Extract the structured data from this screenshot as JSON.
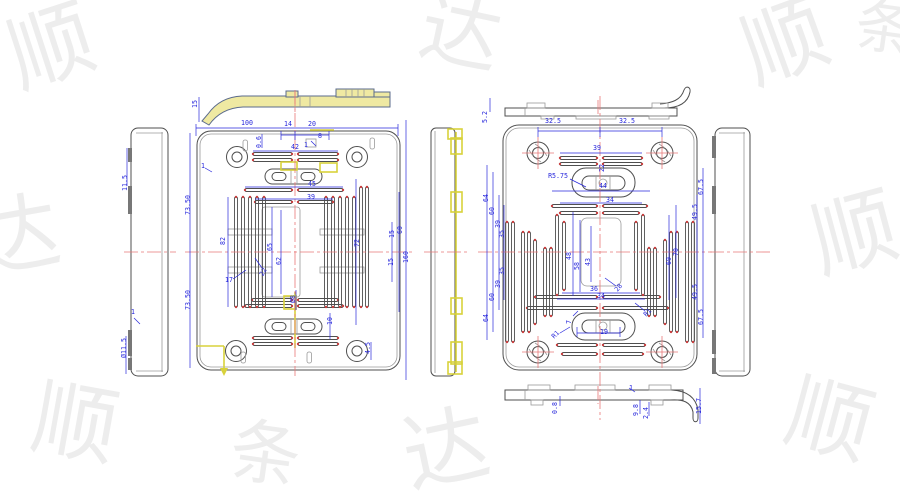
{
  "colors": {
    "background": "#FFFFFF",
    "dimension": "#2828DC",
    "geometry": "#4F4F4F",
    "highlight": "#D8D23B",
    "highlight_fill": "#EFE9A2",
    "centerline": "#E87878",
    "endpoint_marker": "#C84040",
    "watermark": "#EDEDED"
  },
  "dim_labels": [
    {
      "t": "15",
      "x": 197,
      "y": 104,
      "r": -90
    },
    {
      "t": "100",
      "x": 247,
      "y": 125,
      "r": 0
    },
    {
      "t": "14",
      "x": 288,
      "y": 126,
      "r": 0
    },
    {
      "t": "20",
      "x": 312,
      "y": 126,
      "r": 0
    },
    {
      "t": "0.6",
      "x": 261,
      "y": 142,
      "r": -90
    },
    {
      "t": "8",
      "x": 320,
      "y": 138,
      "r": 0
    },
    {
      "t": "1",
      "x": 306,
      "y": 147,
      "r": 0
    },
    {
      "t": "42",
      "x": 295,
      "y": 149,
      "r": 0
    },
    {
      "t": "1",
      "x": 203,
      "y": 168,
      "r": 0
    },
    {
      "t": "45",
      "x": 312,
      "y": 186,
      "r": 0
    },
    {
      "t": "39",
      "x": 311,
      "y": 199,
      "r": 0
    },
    {
      "t": "73.50",
      "x": 190,
      "y": 205,
      "r": -90
    },
    {
      "t": "73.50",
      "x": 190,
      "y": 300,
      "r": -90
    },
    {
      "t": "82",
      "x": 225,
      "y": 241,
      "r": -90
    },
    {
      "t": "17",
      "x": 229,
      "y": 282,
      "r": 0
    },
    {
      "t": "65",
      "x": 272,
      "y": 247,
      "r": -90
    },
    {
      "t": "62",
      "x": 281,
      "y": 261,
      "r": -90
    },
    {
      "t": "22",
      "x": 265,
      "y": 273,
      "r": -60
    },
    {
      "t": "72",
      "x": 359,
      "y": 243,
      "r": -90
    },
    {
      "t": "15",
      "x": 394,
      "y": 234,
      "r": -90
    },
    {
      "t": "60",
      "x": 402,
      "y": 230,
      "r": -90
    },
    {
      "t": "15",
      "x": 393,
      "y": 262,
      "r": -90
    },
    {
      "t": "160",
      "x": 408,
      "y": 257,
      "r": -90
    },
    {
      "t": "Ø8",
      "x": 295,
      "y": 299,
      "r": -90
    },
    {
      "t": "10",
      "x": 332,
      "y": 321,
      "r": -90
    },
    {
      "t": "4.5",
      "x": 370,
      "y": 348,
      "r": -90
    },
    {
      "t": "11.5",
      "x": 127,
      "y": 183,
      "r": -90
    },
    {
      "t": "1",
      "x": 133,
      "y": 314,
      "r": 0
    },
    {
      "t": "Ø11.5",
      "x": 126,
      "y": 348,
      "r": -90
    },
    {
      "t": "5.2",
      "x": 487,
      "y": 117,
      "r": -90
    },
    {
      "t": "32.5",
      "x": 553,
      "y": 123,
      "r": 0
    },
    {
      "t": "32.5",
      "x": 627,
      "y": 123,
      "r": 0
    },
    {
      "t": "39",
      "x": 597,
      "y": 150,
      "r": 0
    },
    {
      "t": "R5.75",
      "x": 558,
      "y": 178,
      "r": 0
    },
    {
      "t": "22",
      "x": 604,
      "y": 168,
      "r": -90
    },
    {
      "t": "44",
      "x": 603,
      "y": 188,
      "r": 0
    },
    {
      "t": "34",
      "x": 610,
      "y": 202,
      "r": 0
    },
    {
      "t": "64",
      "x": 488,
      "y": 198,
      "r": -90
    },
    {
      "t": "60",
      "x": 494,
      "y": 211,
      "r": -90
    },
    {
      "t": "39",
      "x": 500,
      "y": 224,
      "r": -90
    },
    {
      "t": "35",
      "x": 504,
      "y": 234,
      "r": -90
    },
    {
      "t": "35",
      "x": 504,
      "y": 271,
      "r": -90
    },
    {
      "t": "39",
      "x": 500,
      "y": 284,
      "r": -90
    },
    {
      "t": "60",
      "x": 494,
      "y": 297,
      "r": -90
    },
    {
      "t": "64",
      "x": 488,
      "y": 318,
      "r": -90
    },
    {
      "t": "48",
      "x": 571,
      "y": 256,
      "r": -90
    },
    {
      "t": "58",
      "x": 579,
      "y": 266,
      "r": -90
    },
    {
      "t": "43",
      "x": 590,
      "y": 262,
      "r": -90
    },
    {
      "t": "36",
      "x": 594,
      "y": 291,
      "r": 0
    },
    {
      "t": "34",
      "x": 601,
      "y": 298,
      "r": 0
    },
    {
      "t": "28",
      "x": 620,
      "y": 289,
      "r": -50
    },
    {
      "t": "69",
      "x": 671,
      "y": 261,
      "r": -90
    },
    {
      "t": "70",
      "x": 678,
      "y": 252,
      "r": -90
    },
    {
      "t": "49.5",
      "x": 697,
      "y": 212,
      "r": -90
    },
    {
      "t": "67.5",
      "x": 703,
      "y": 187,
      "r": -90
    },
    {
      "t": "49.5",
      "x": 697,
      "y": 292,
      "r": -90
    },
    {
      "t": "67.5",
      "x": 703,
      "y": 317,
      "r": -90
    },
    {
      "t": "R1",
      "x": 649,
      "y": 314,
      "r": -45
    },
    {
      "t": "R1",
      "x": 557,
      "y": 336,
      "r": -45
    },
    {
      "t": "19",
      "x": 604,
      "y": 334,
      "r": 0
    },
    {
      "t": "7",
      "x": 571,
      "y": 322,
      "r": -90
    },
    {
      "t": "1",
      "x": 631,
      "y": 390,
      "r": 0
    },
    {
      "t": "0.8",
      "x": 557,
      "y": 408,
      "r": -90
    },
    {
      "t": "9.8",
      "x": 638,
      "y": 410,
      "r": -90
    },
    {
      "t": "2.4",
      "x": 648,
      "y": 413,
      "r": -90
    },
    {
      "t": "15.7",
      "x": 701,
      "y": 406,
      "r": -90
    }
  ],
  "watermark": {
    "glyphs": [
      {
        "c": "顺",
        "x": 60,
        "y": 75,
        "r": -18,
        "s": 85
      },
      {
        "c": "达",
        "x": 455,
        "y": 60,
        "r": 12,
        "s": 80
      },
      {
        "c": "顺",
        "x": 795,
        "y": 70,
        "r": -20,
        "s": 85
      },
      {
        "c": "条",
        "x": 882,
        "y": 48,
        "r": 8,
        "s": 58
      },
      {
        "c": "达",
        "x": 22,
        "y": 265,
        "r": -10,
        "s": 85
      },
      {
        "c": "顺",
        "x": 862,
        "y": 262,
        "r": -15,
        "s": 85
      },
      {
        "c": "顺",
        "x": 70,
        "y": 452,
        "r": 10,
        "s": 85
      },
      {
        "c": "达",
        "x": 452,
        "y": 478,
        "r": -12,
        "s": 85
      },
      {
        "c": "顺",
        "x": 822,
        "y": 448,
        "r": 15,
        "s": 85
      },
      {
        "c": "条",
        "x": 262,
        "y": 478,
        "r": 8,
        "s": 70
      }
    ]
  }
}
